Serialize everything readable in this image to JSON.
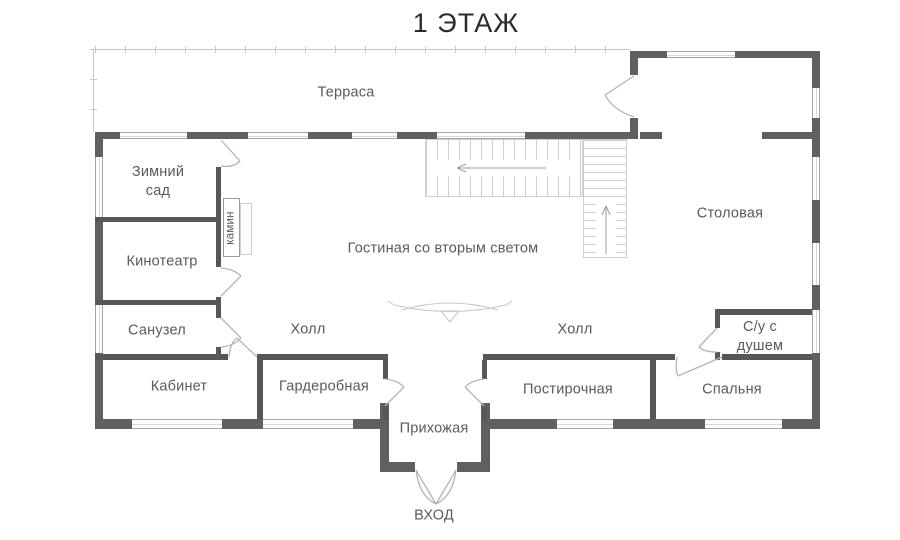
{
  "title": "1 ЭТАЖ",
  "colors": {
    "wall": "#606060",
    "interior": "#575757",
    "label": "#5a5a5a",
    "title": "#2b2b2b",
    "line": "#c8c8c8",
    "door": "#b4b4b4",
    "arrow": "#9e9e9e"
  },
  "rooms": [
    {
      "name": "terrace",
      "label": "Терраса",
      "x": 346,
      "y": 93
    },
    {
      "name": "winter-garden",
      "label": "Зимний\nсад",
      "x": 158,
      "y": 182
    },
    {
      "name": "cinema",
      "label": "Кинотеатр",
      "x": 162,
      "y": 262
    },
    {
      "name": "fireplace",
      "label": "камин",
      "x": 231,
      "y": 228,
      "rotate": true,
      "size": 11.5
    },
    {
      "name": "living-room",
      "label": "Гостиная со вторым светом",
      "x": 443,
      "y": 249
    },
    {
      "name": "dining-room",
      "label": "Столовая",
      "x": 730,
      "y": 214
    },
    {
      "name": "bathroom",
      "label": "Санузел",
      "x": 157,
      "y": 331
    },
    {
      "name": "hall-left",
      "label": "Холл",
      "x": 308,
      "y": 330
    },
    {
      "name": "hall-right",
      "label": "Холл",
      "x": 575,
      "y": 330
    },
    {
      "name": "office",
      "label": "Кабинет",
      "x": 179,
      "y": 387
    },
    {
      "name": "wardrobe",
      "label": "Гардеробная",
      "x": 324,
      "y": 387
    },
    {
      "name": "laundry",
      "label": "Постирочная",
      "x": 568,
      "y": 390
    },
    {
      "name": "bedroom",
      "label": "Спальня",
      "x": 732,
      "y": 390
    },
    {
      "name": "shower-bathroom",
      "label": "С/у с\nдушем",
      "x": 760,
      "y": 337
    },
    {
      "name": "entry-hall",
      "label": "Прихожая",
      "x": 434,
      "y": 429
    },
    {
      "name": "entrance",
      "label": "ВХОД",
      "x": 434,
      "y": 516
    }
  ]
}
